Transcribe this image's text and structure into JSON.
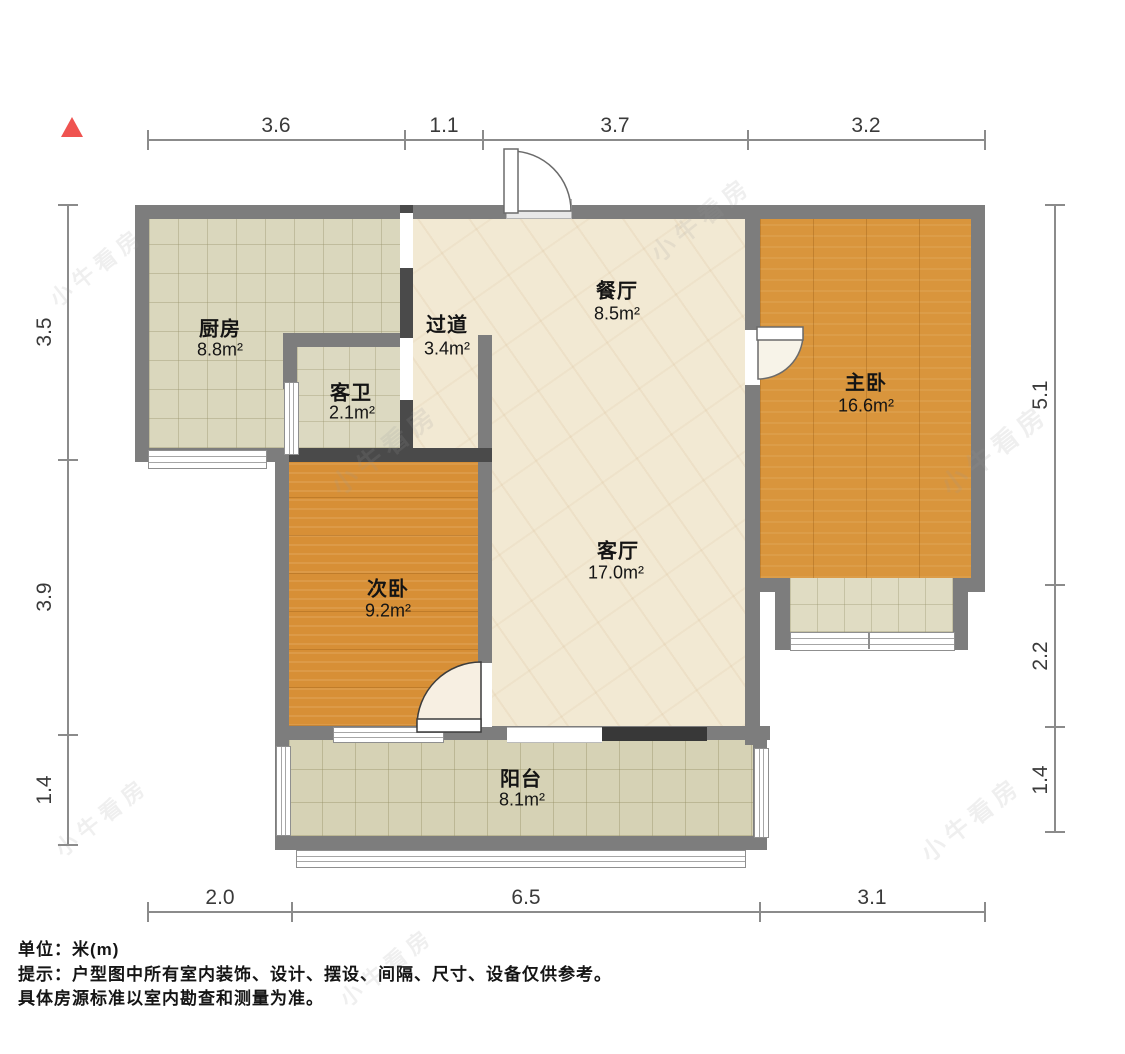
{
  "title": "户型图",
  "watermark": {
    "text": "小牛看房"
  },
  "icons": {
    "north_arrow": "red-triangle-up"
  },
  "rooms": [
    {
      "id": "kitchen",
      "name": "厨房",
      "area": "8.8m²"
    },
    {
      "id": "guest-bath",
      "name": "客卫",
      "area": "2.1m²"
    },
    {
      "id": "hallway",
      "name": "过道",
      "area": "3.4m²"
    },
    {
      "id": "dining",
      "name": "餐厅",
      "area": "8.5m²"
    },
    {
      "id": "master-bedroom",
      "name": "主卧",
      "area": "16.6m²"
    },
    {
      "id": "second-bedroom",
      "name": "次卧",
      "area": "9.2m²"
    },
    {
      "id": "living",
      "name": "客厅",
      "area": "17.0m²"
    },
    {
      "id": "balcony",
      "name": "阳台",
      "area": "8.1m²"
    }
  ],
  "dimensions": {
    "top": [
      "3.6",
      "1.1",
      "3.7",
      "3.2"
    ],
    "bottom": [
      "2.0",
      "6.5",
      "3.1"
    ],
    "left": [
      "3.5",
      "3.9",
      "1.4"
    ],
    "right": [
      "5.1",
      "2.2",
      "1.4"
    ]
  },
  "footer": {
    "unit": "单位：米(m)",
    "note1": "提示：户型图中所有室内装饰、设计、摆设、间隔、尺寸、设备仅供参考。",
    "note2": "具体房源标准以室内勘查和测量为准。"
  },
  "colors": {
    "wall": "#7d7d7d",
    "wall_dark": "#4a4a4a",
    "north_arrow": "#ef5350",
    "wood": "#d8923a",
    "kitchen_tile": "#dad7bd",
    "marble": "#f2e9d3",
    "balcony_tile": "#d6d2b5"
  }
}
